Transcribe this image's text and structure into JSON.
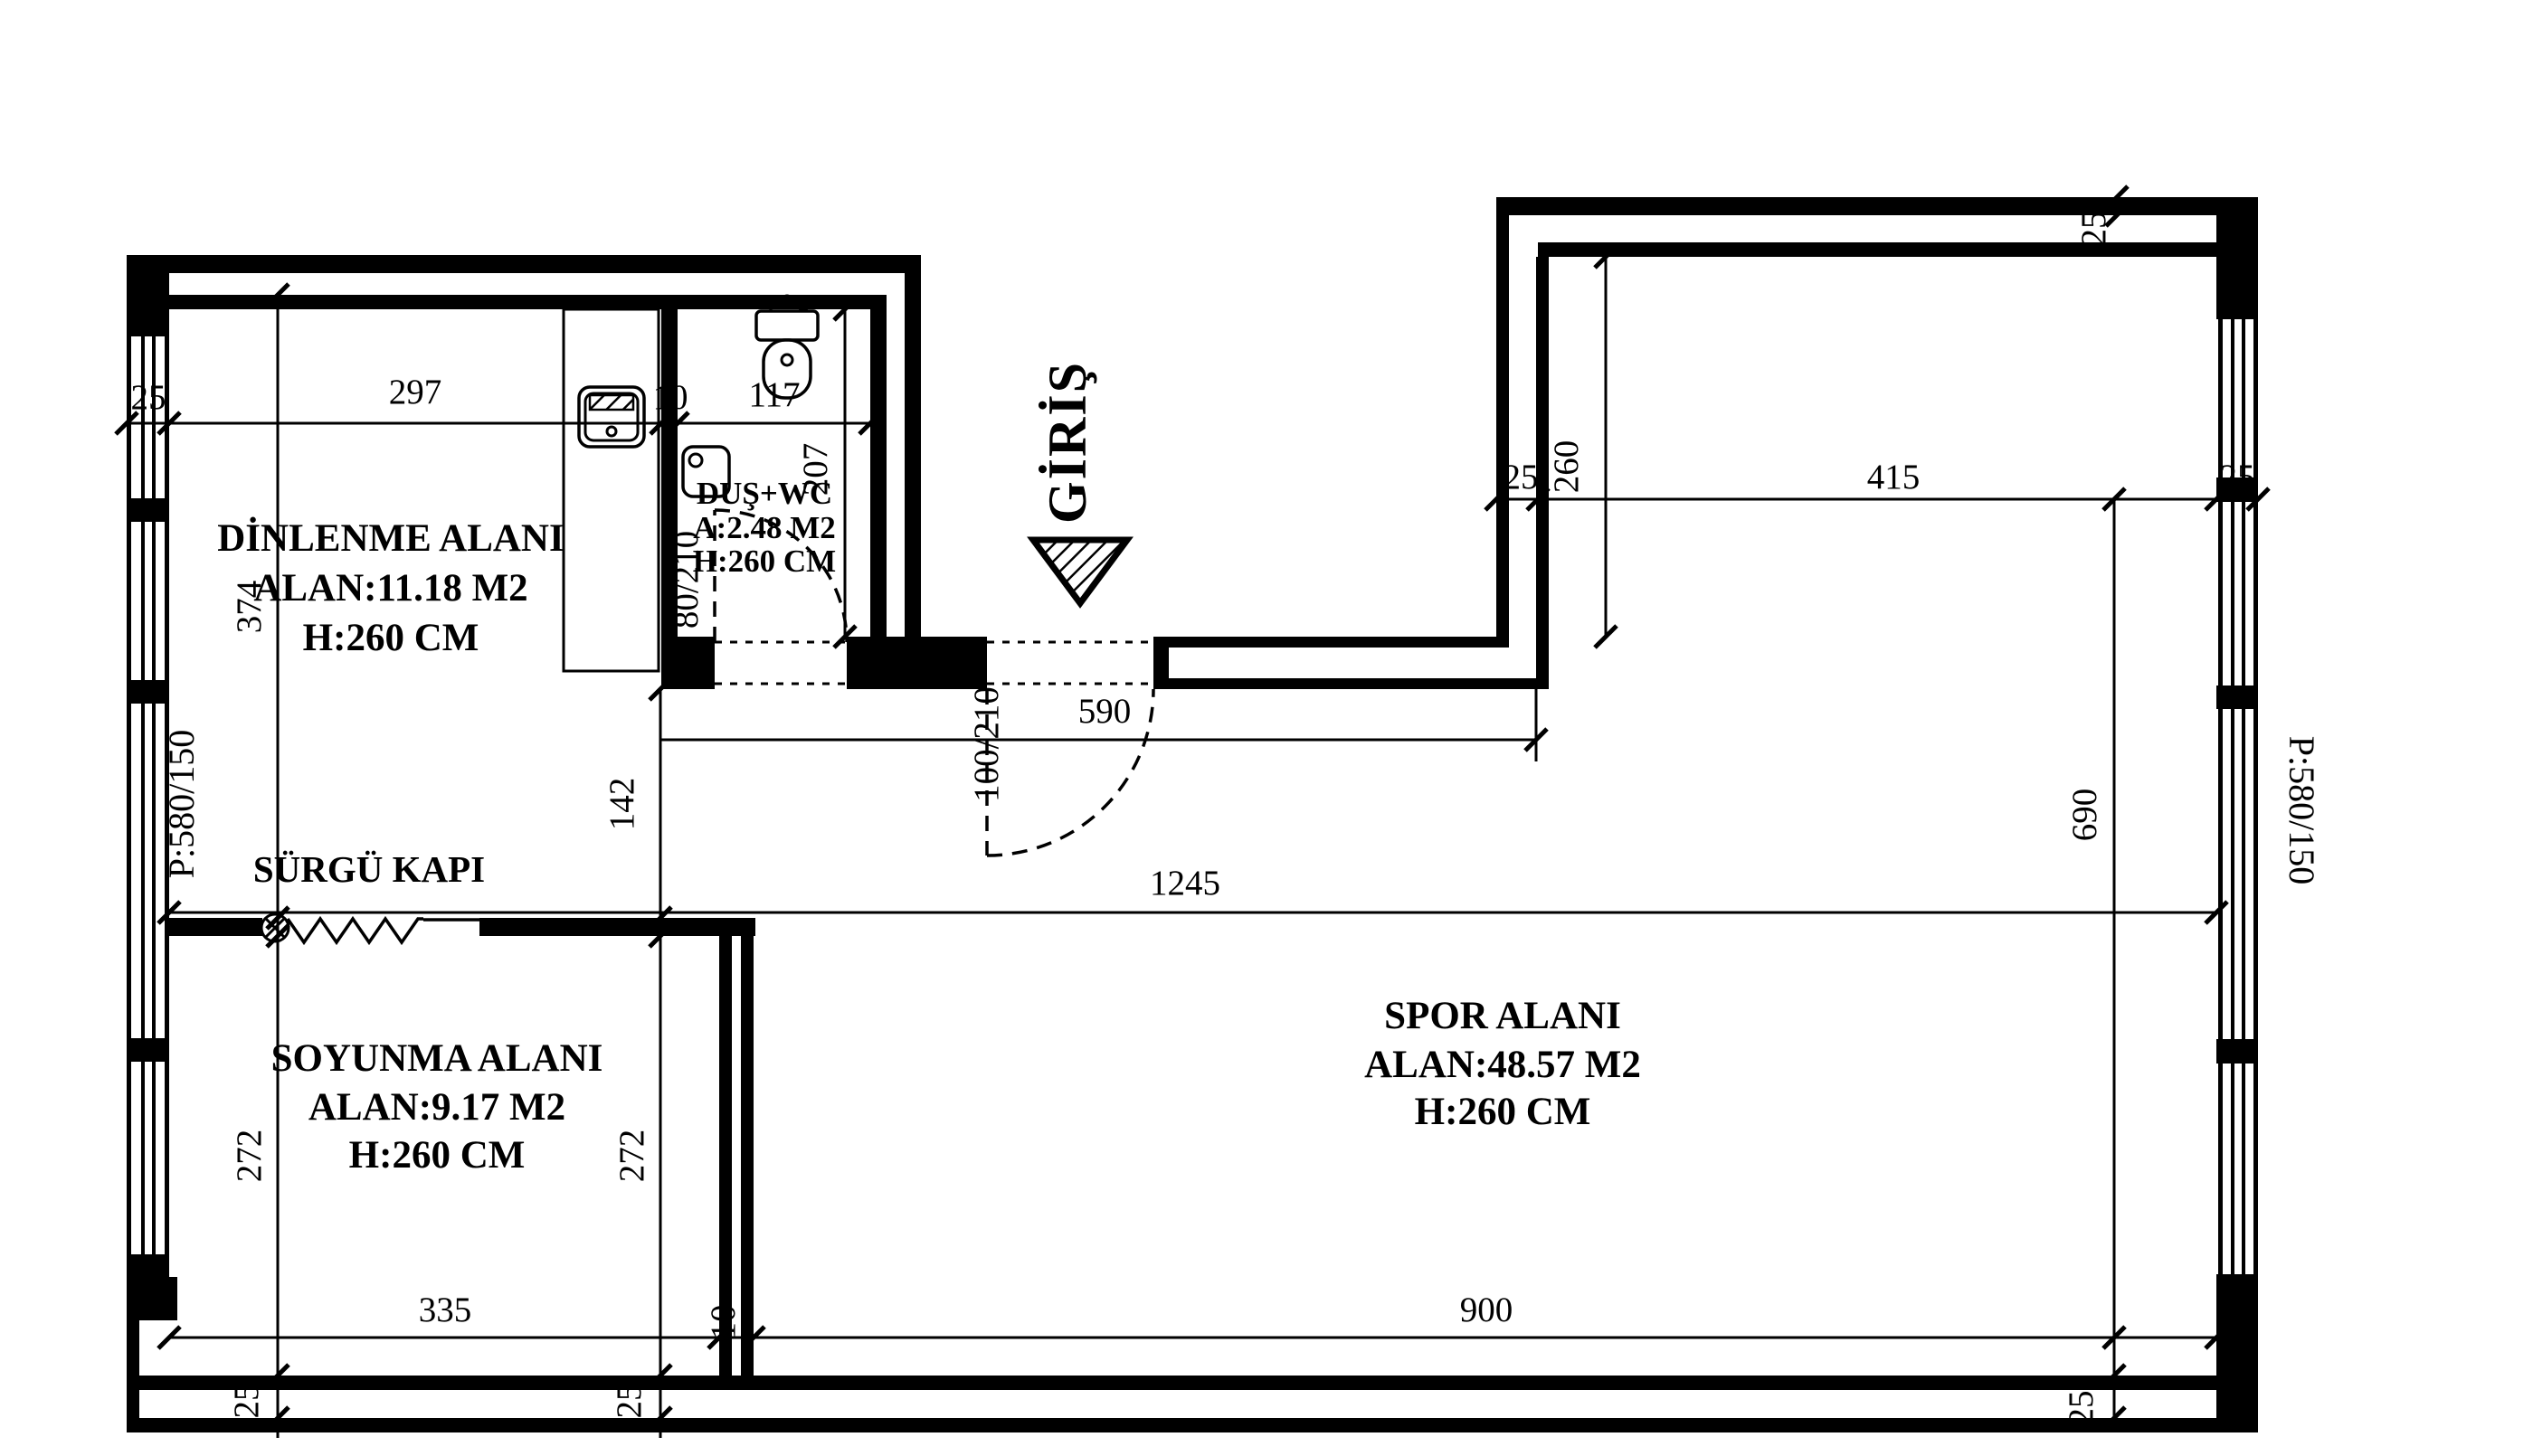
{
  "colors": {
    "ink": "#000000",
    "paper": "#ffffff"
  },
  "rooms": {
    "dinlenme": {
      "title": "DİNLENME ALANI",
      "area": "ALAN:11.18 M2",
      "height": "H:260 CM"
    },
    "dus_wc": {
      "title": "DUŞ+WC",
      "area": "A:2.48 M2",
      "height": "H:260 CM"
    },
    "soyunma": {
      "title": "SOYUNMA ALANI",
      "area": "ALAN:9.17 M2",
      "height": "H:260 CM"
    },
    "spor": {
      "title": "SPOR ALANI",
      "area": "ALAN:48.57 M2",
      "height": "H:260 CM"
    }
  },
  "labels": {
    "entrance": "GİRİŞ",
    "sliding_door": "SÜRGÜ KAPI"
  },
  "windows": {
    "left": "P:580/150",
    "right": "P:580/150"
  },
  "dims": {
    "wall_top_left": "25",
    "dinlenme_width": "297",
    "bath_partition": "10",
    "bath_width": "117",
    "dinlenme_height": "374",
    "bath_height": "207",
    "below_bath": "142",
    "entry_span": "590",
    "door_entry": "100/210",
    "door_bath": "80/210",
    "total_width": "1245",
    "soyunma_height_left": "272",
    "soyunma_height_right": "272",
    "soyunma_width": "335",
    "bottom_partition": "10",
    "spor_width": "900",
    "bottom_wall_left": "25",
    "bottom_wall_mid": "25",
    "bottom_wall_right": "25",
    "alcove_wall_left": "25",
    "alcove_width": "415",
    "alcove_wall_right": "25",
    "top_wall_right": "25",
    "alcove_depth": "260",
    "right_height": "690"
  }
}
